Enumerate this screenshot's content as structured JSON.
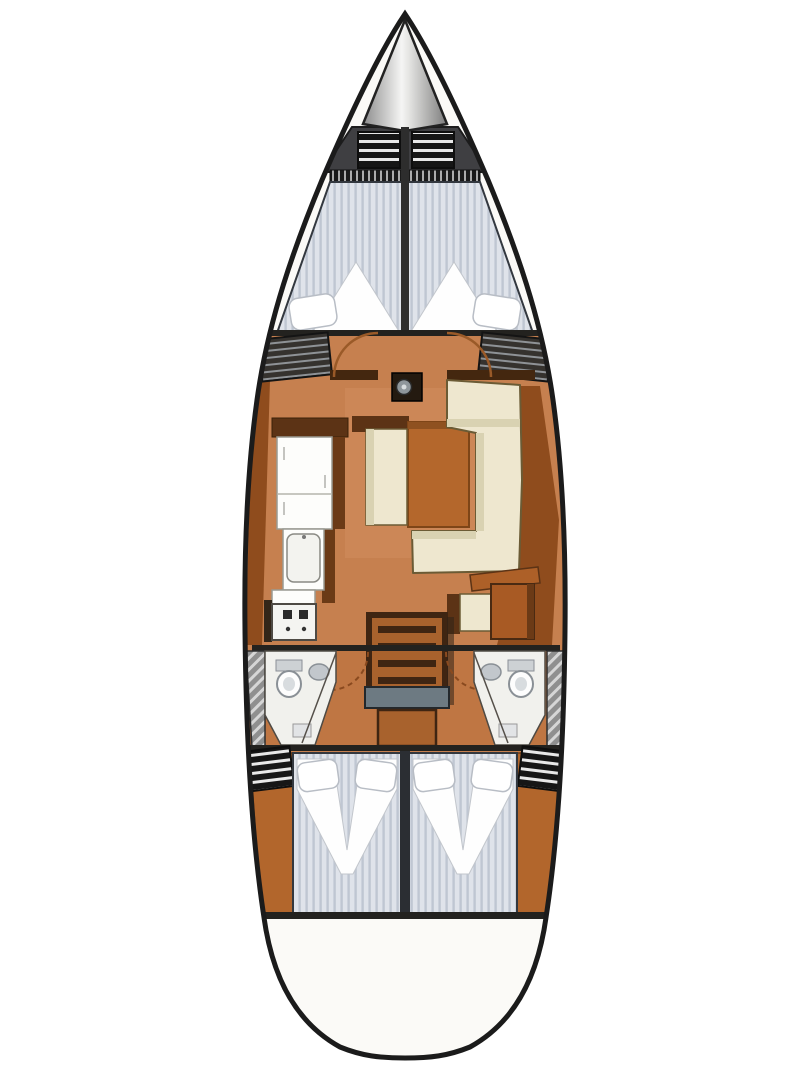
{
  "meta": {
    "kind": "sailing-yacht-interior-floor-plan",
    "view": "top-down",
    "orientation": "bow-up"
  },
  "colors": {
    "page_bg": "#ffffff",
    "hull_outline": "#1b1b1b",
    "deck": "#fbfaf7",
    "floor": "#c6804f",
    "floor_salon_light": "#d18e60",
    "floor_aft_dark": "#b56b36",
    "side_panel": "#8f4c1d",
    "wood_dark": "#5c3315",
    "wood_mid": "#a8622d",
    "wood_edge": "#3f2512",
    "wall_dark": "#44270f",
    "bulkhead": "#23221f",
    "sofa": "#eee7cf",
    "sofa_shade": "#d9d2b2",
    "table": "#b4672c",
    "table_edge": "#7e4517",
    "bench_shadow": "#5c3315",
    "counter_white": "#fdfdfb",
    "stove_white": "#f4f4f1",
    "burner_dark": "#2b2b2b",
    "mattress_base": "#dfe3ea",
    "mattress_stripe": "#bfc6d2",
    "mattress_outline": "#33383f",
    "bedding_white": "#fefefe",
    "pillow_stroke": "#b8bdc5",
    "vent_base": "#161616",
    "vent_stripe": "#e8e8e8",
    "bow_band": "#3f3f42",
    "anchor_light": "#f5f5f4",
    "anchor_dark": "#8c8c8c",
    "keel_line": "#2d2d2d",
    "locker_gray": "#8f8f8f",
    "locker_stripe": "#d6d6d6",
    "head_floor": "#f1f1ed",
    "fixture_gray": "#c2c7cc",
    "fixture_stroke": "#8a9096",
    "companion_step_gray": "#6d7a82",
    "aft_wedge": "#b2662c",
    "door_arc": "#9a5a28",
    "mast_metal": "#8f969b"
  },
  "areas": {
    "bow": {
      "anchor_locker": 1,
      "deck_hatches": 2,
      "vent_strip": 1
    },
    "forward_cabin": {
      "berth": "v-berth double",
      "pillows": 2,
      "duvets": 2,
      "wardrobes": 2,
      "door_arcs": 2
    },
    "saloon": {
      "sofa": "C-shaped settee",
      "center_bench": 1,
      "table": 1,
      "mast_post": 1
    },
    "galley": {
      "counters": 3,
      "sink": 1,
      "stove_burners": 4
    },
    "nav_station": {
      "seat": 1,
      "chart_table": 1,
      "sideboard": 1
    },
    "companionway": {
      "steps": 4,
      "landing_step": 1,
      "engine_box": 1
    },
    "heads": {
      "count": 2,
      "fixtures_each": [
        "toilet",
        "sink",
        "cabinet"
      ]
    },
    "aft_cabins": {
      "count": 2,
      "berth_each": "double",
      "pillows_each": 2,
      "corner_vents": 2
    },
    "stern": {
      "platform": "rounded swim platform"
    }
  }
}
